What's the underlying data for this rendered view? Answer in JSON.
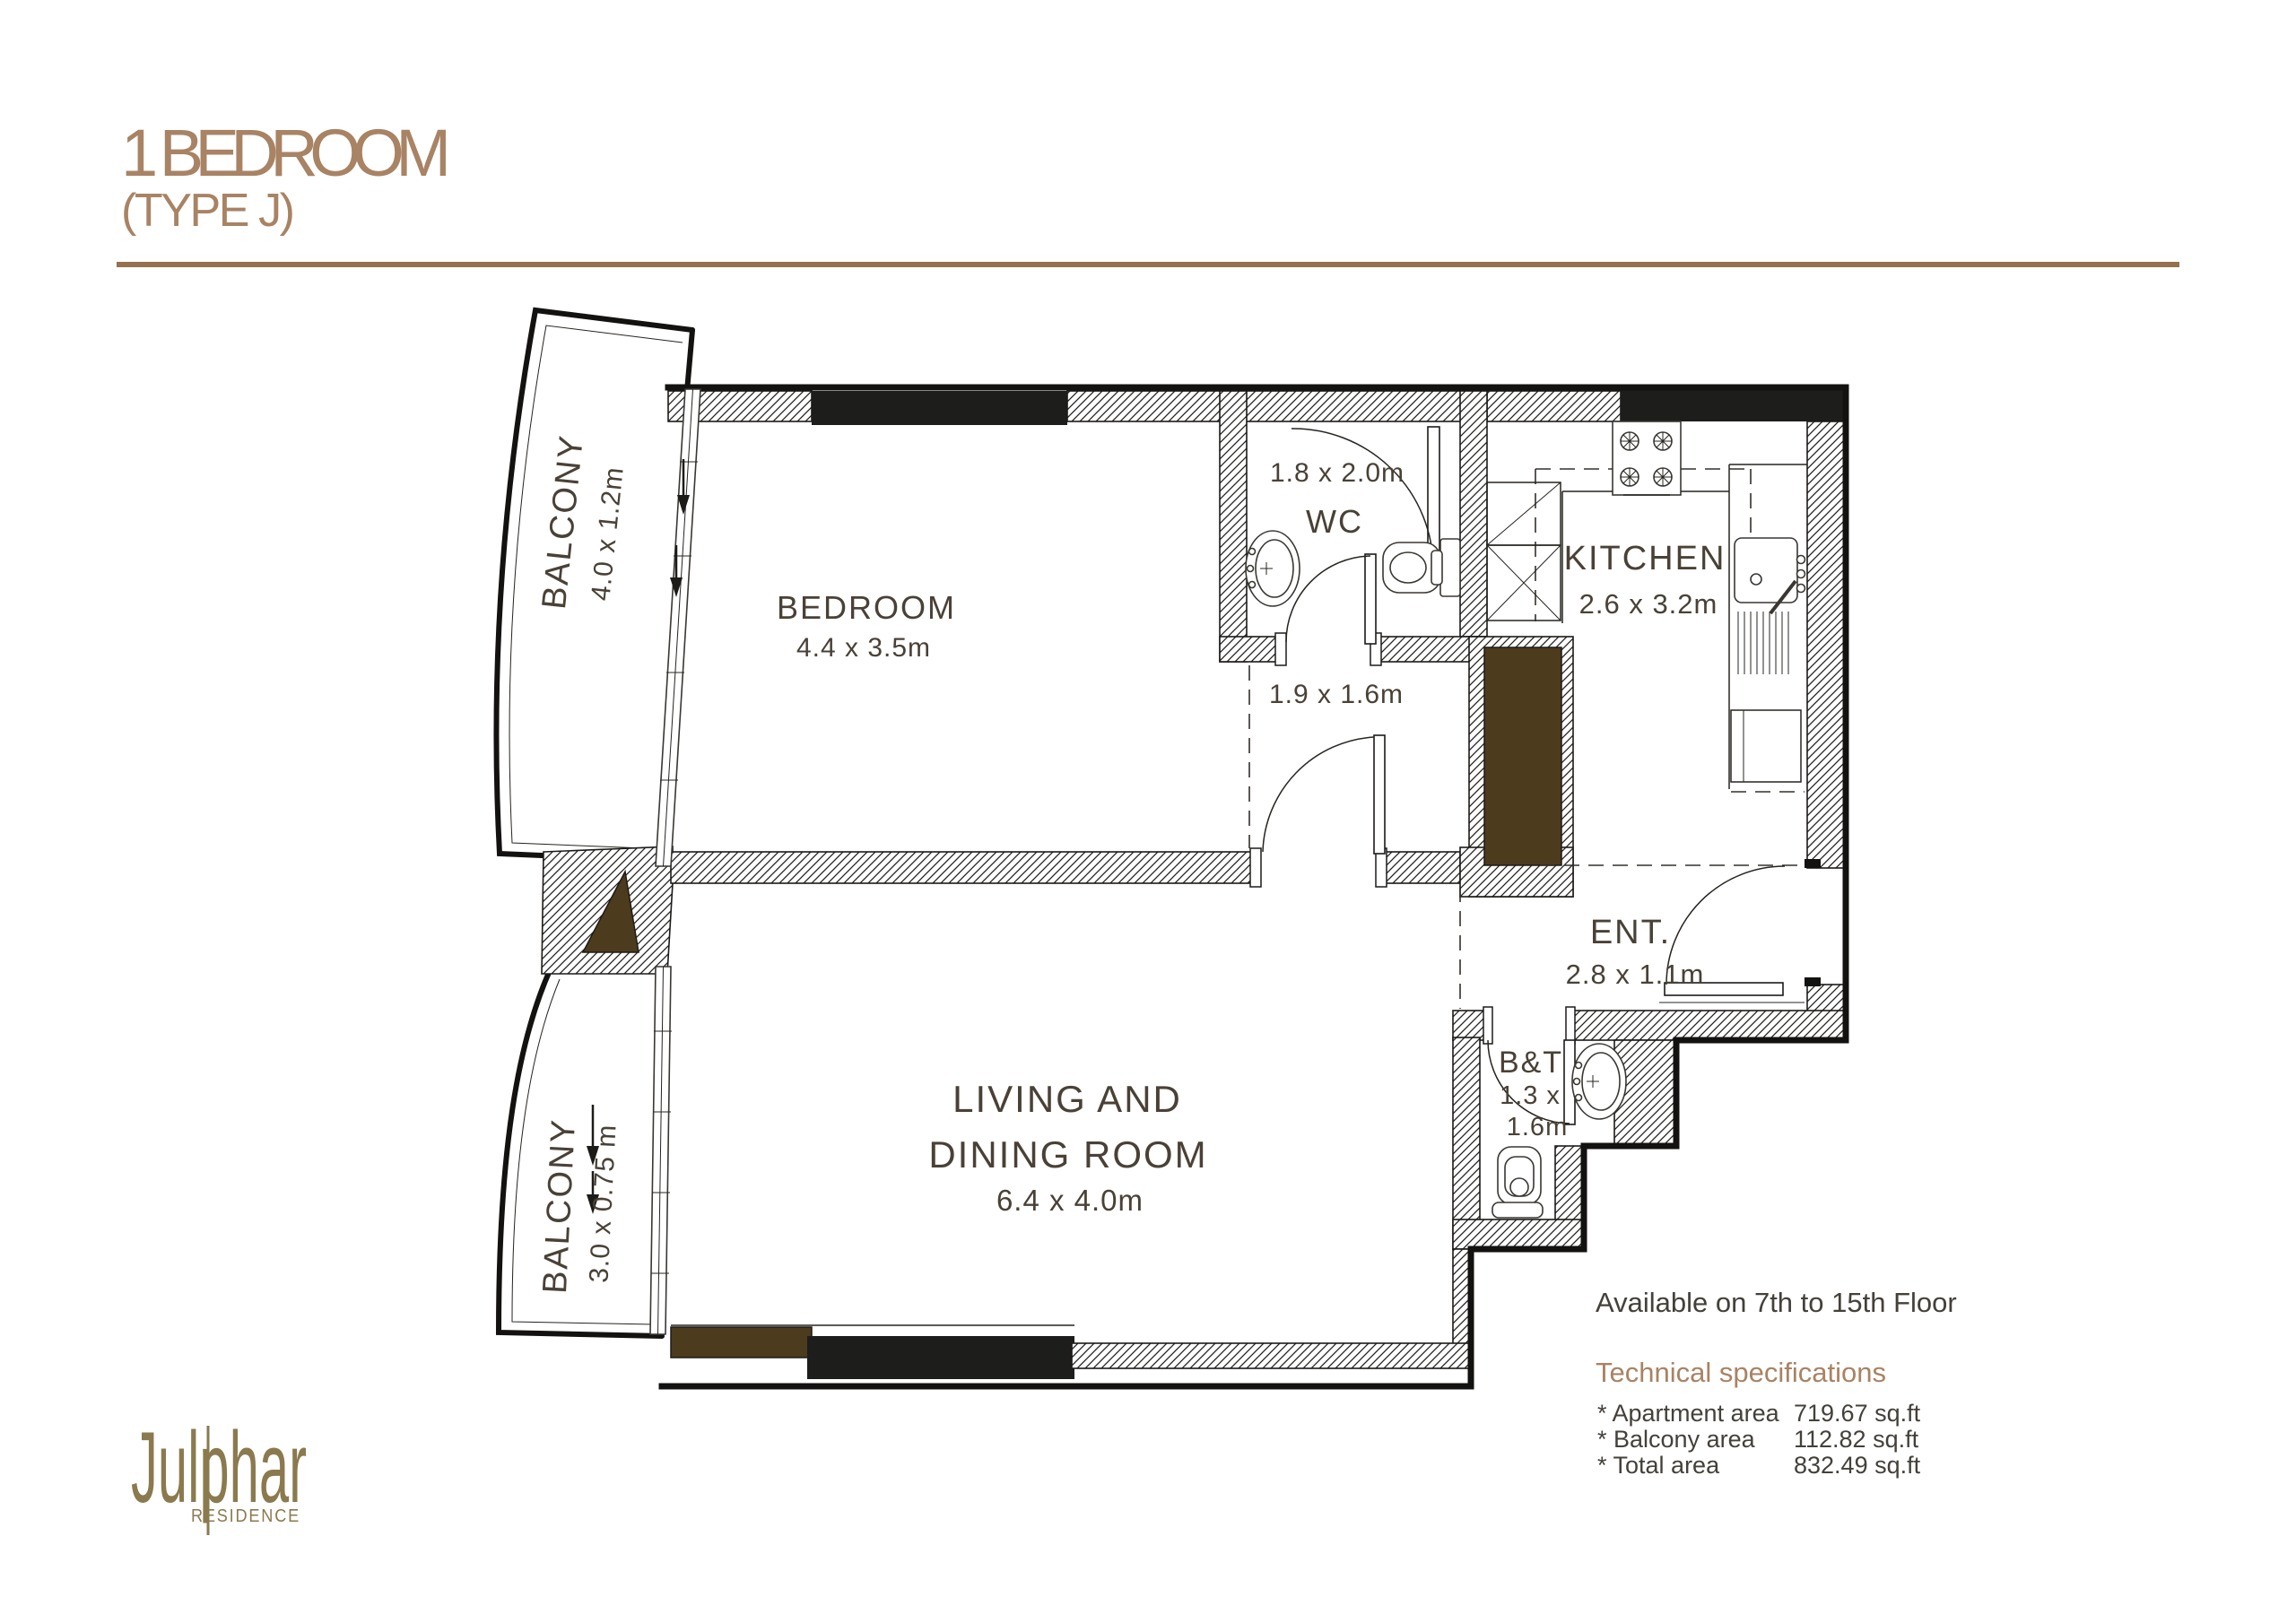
{
  "title": {
    "main": "1 BEDROOM",
    "sub": "(TYPE J)"
  },
  "availability": "Available on 7th to 15th Floor",
  "specs": {
    "heading": "Technical specifications",
    "rows": [
      {
        "label": "* Apartment area",
        "value": "719.67 sq.ft"
      },
      {
        "label": "* Balcony area",
        "value": "112.82 sq.ft"
      },
      {
        "label": "* Total area",
        "value": "832.49 sq.ft"
      }
    ]
  },
  "rooms": {
    "bedroom": {
      "name": "BEDROOM",
      "dims": "4.4 x 3.5m"
    },
    "wc": {
      "name": "WC",
      "dims": "1.8 x 2.0m"
    },
    "corridor": {
      "dims": "1.9 x 1.6m"
    },
    "kitchen": {
      "name": "KITCHEN",
      "dims": "2.6 x 3.2m"
    },
    "ent": {
      "name": "ENT.",
      "dims": "2.8 x 1.1m"
    },
    "bt": {
      "name": "B&T",
      "dims_line1": "1.3 x",
      "dims_line2": "1.6m"
    },
    "living": {
      "name_line1": "LIVING AND",
      "name_line2": "DINING ROOM",
      "dims": "6.4 x 4.0m"
    },
    "balcony_upper": {
      "name": "BALCONY",
      "dims": "4.0 x 1.2m"
    },
    "balcony_lower": {
      "name": "BALCONY",
      "dims": "3.0 x 0.75 m"
    }
  },
  "logo": {
    "brand": "Julphar",
    "sub": "RESIDENCE"
  },
  "colors": {
    "accent": "#a88364",
    "rule": "#96714e",
    "text_dark": "#44403a",
    "room_label": "#4a4136",
    "shaft_brown": "#4d3b1d",
    "window_black": "#1d1d1b",
    "logo_gold": "#8a7a4e"
  }
}
